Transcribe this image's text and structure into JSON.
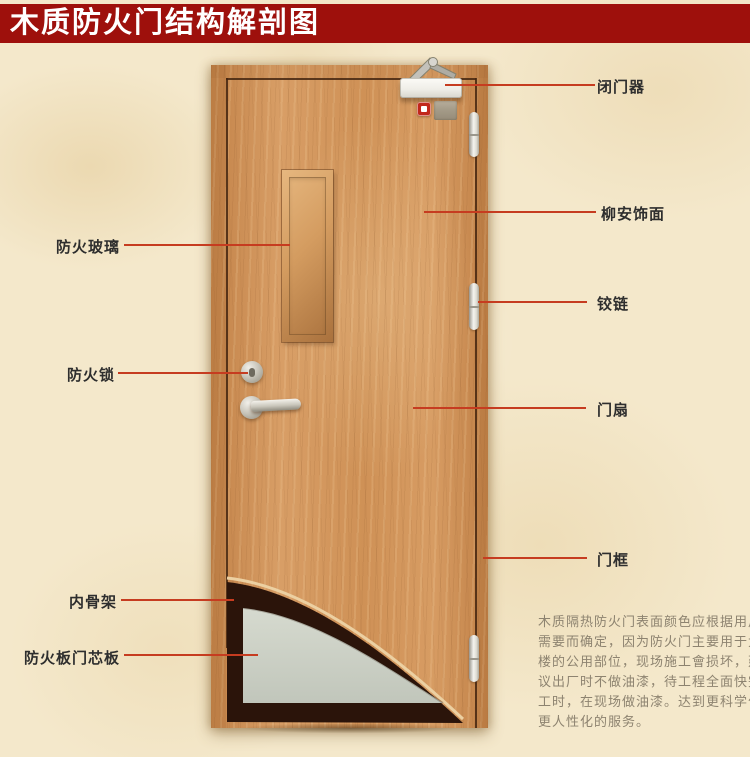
{
  "title": "木质防火门结构解剖图",
  "colors": {
    "title_bar": "#9e100c",
    "title_text": "#ffffff",
    "background": "#f4e8cb",
    "leader_line": "#c63c20",
    "label_text": "#2e2e2e",
    "paragraph_text": "#8d8370",
    "cutaway_dark": "#2b140a"
  },
  "callouts": {
    "left": [
      {
        "id": "fire-glass",
        "label": "防火玻璃"
      },
      {
        "id": "fire-lock",
        "label": "防火锁"
      },
      {
        "id": "inner-skeleton",
        "label": "内骨架"
      },
      {
        "id": "fire-board-core",
        "label": "防火板门芯板"
      }
    ],
    "right": [
      {
        "id": "door-closer",
        "label": "闭门器"
      },
      {
        "id": "lauan-veneer",
        "label": "柳安饰面"
      },
      {
        "id": "hinge",
        "label": "铰链"
      },
      {
        "id": "door-leaf",
        "label": "门扇"
      },
      {
        "id": "door-frame",
        "label": "门框"
      }
    ]
  },
  "description": {
    "lines": [
      "木质隔热防火门表面颜色应根据用户",
      "需要而确定，因为防火门主要用于大",
      "楼的公用部位，现场施工會损坏，建",
      "议出厂时不做油漆，待工程全面快完",
      "工时，在现场做油漆。达到更科学化",
      "更人性化的服务。"
    ]
  }
}
